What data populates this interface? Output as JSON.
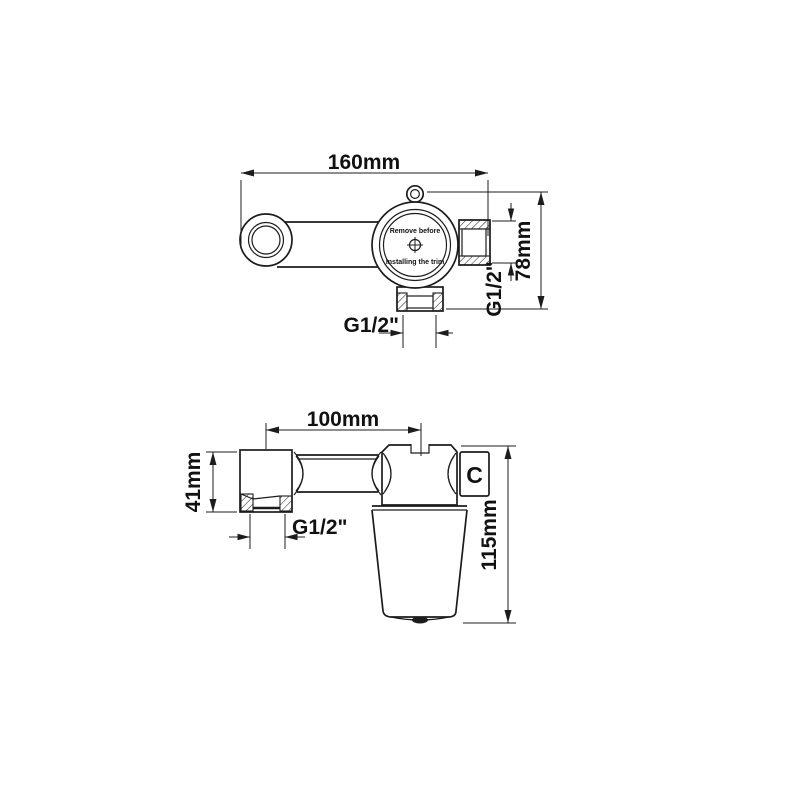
{
  "colors": {
    "line": "#1c1c1c",
    "background": "#ffffff"
  },
  "front_view": {
    "width_dim": "160mm",
    "height_dim": "78mm",
    "side_port_thread": "G1/2\"",
    "bottom_port_thread": "G1/2\"",
    "cap_note_line1": "Remove before",
    "cap_note_line2": "Installing the trim"
  },
  "side_view": {
    "center_distance_dim": "100mm",
    "end_block_height_dim": "41mm",
    "inlet_thread": "G1/2\"",
    "body_marker": "C",
    "total_height_dim": "115mm"
  }
}
